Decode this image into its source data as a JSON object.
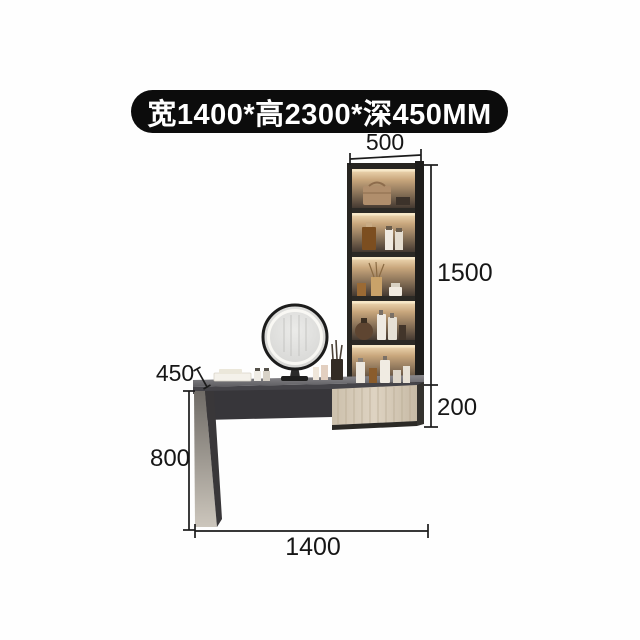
{
  "banner": {
    "text": "宽1400*高2300*深450MM"
  },
  "dimensions": {
    "shelf_width_mm": "500",
    "shelf_height_mm": "1500",
    "drawer_height_mm": "200",
    "desk_depth_mm": "450",
    "leg_height_mm": "800",
    "total_width_mm": "1400"
  },
  "colors": {
    "background": "#fefefe",
    "banner_bg": "#0c0c0c",
    "banner_text": "#ffffff",
    "dimension_lines": "#1b1b1b",
    "cabinet_frame": "#2a2824",
    "shelf_glow": "#e8cfa6",
    "drawer_wood": "#d6cab8",
    "tabletop": "#5a595d"
  }
}
